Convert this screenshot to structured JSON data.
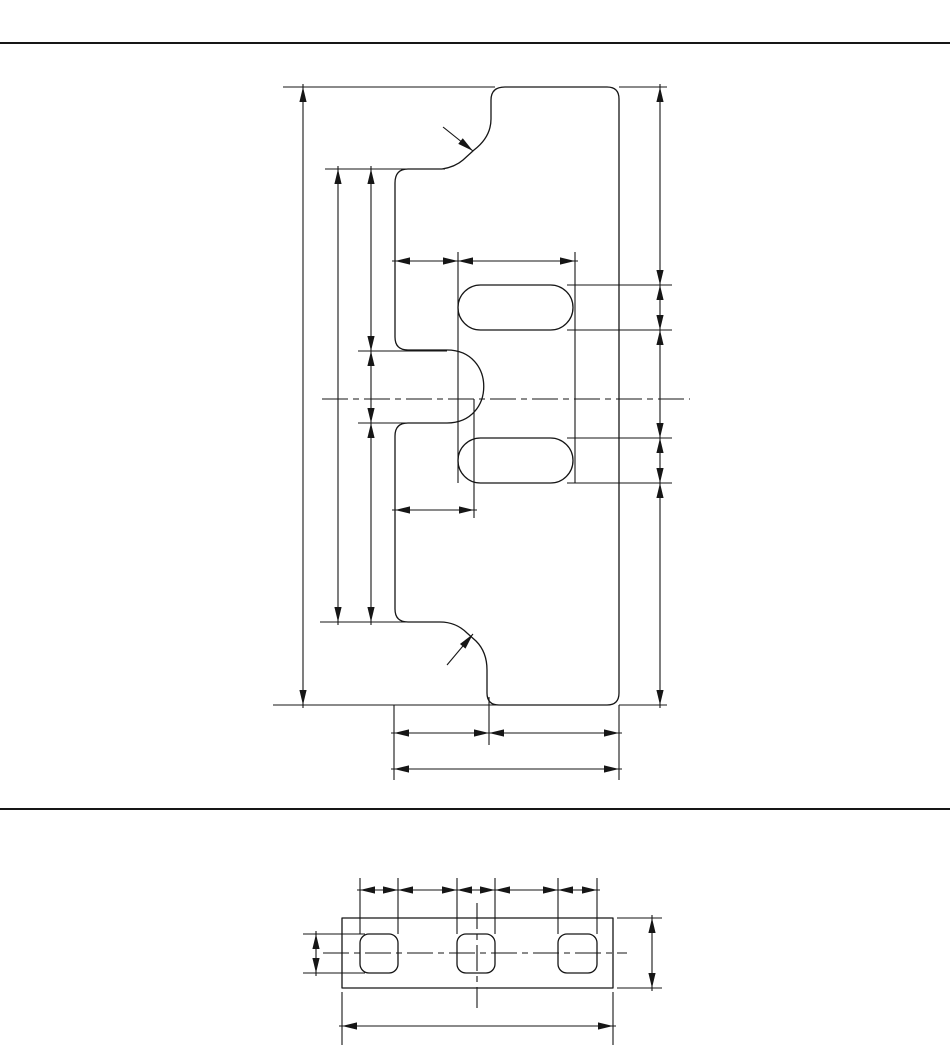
{
  "page": {
    "background": "#ffffff",
    "line_color": "#161616",
    "outline_stroke_width": 1.3,
    "thin_stroke_width": 1.1,
    "arrow_length": 15,
    "arrow_half_width": 3.6,
    "centerline_dash": "26 5 6 5"
  },
  "rules": [
    {
      "y": 43,
      "x1": 0,
      "x2": 950,
      "thickness": 2
    },
    {
      "y": 809,
      "x1": 0,
      "x2": 950,
      "thickness": 2
    }
  ],
  "views": [
    {
      "name": "profile-view",
      "outline": "M 505 87 L 607 87 Q 619 87 619 99 L 619 693 Q 619 705 607 705 L 499 705 Q 487 705 487 693 L 487 670 Q 487 652 476 641 L 467 633 Q 456 622 440 622 L 408 622 Q 395 622 395 609 L 395 436 Q 395 423 408 423 L 447 423 C 496 423 496 350 447 350 L 408 350 Q 395 350 395 337 L 395 183 Q 395 169 408 169 L 442 169 Q 455 167 463 160 L 474 150 Q 491 137 491 119 L 491 100 Q 491 87 505 87 Z",
      "slots": [
        {
          "x": 458,
          "y": 285,
          "w": 115,
          "h": 45,
          "r": 22.5
        },
        {
          "x": 458,
          "y": 438,
          "w": 115,
          "h": 45,
          "r": 22.5
        }
      ],
      "centerlines": [
        {
          "x1": 322,
          "y1": 399,
          "x2": 690,
          "y2": 399
        }
      ],
      "extensions": [
        [
          283,
          87,
          495,
          87
        ],
        [
          619,
          87,
          667,
          87
        ],
        [
          325,
          169,
          445,
          169
        ],
        [
          358,
          351,
          447,
          351
        ],
        [
          358,
          423,
          447,
          423
        ],
        [
          320,
          622,
          435,
          622
        ],
        [
          273,
          705,
          500,
          705
        ],
        [
          619,
          705,
          667,
          705
        ],
        [
          567,
          285,
          672,
          285
        ],
        [
          567,
          330,
          672,
          330
        ],
        [
          567,
          438,
          672,
          438
        ],
        [
          567,
          483,
          672,
          483
        ],
        [
          458,
          252,
          458,
          483
        ],
        [
          575,
          252,
          575,
          483
        ],
        [
          474,
          399,
          474,
          518
        ],
        [
          394,
          705,
          394,
          780
        ],
        [
          489,
          697,
          489,
          745
        ],
        [
          619,
          705,
          619,
          780
        ]
      ],
      "dims": [
        {
          "dir": "v",
          "pos": 303,
          "pts": [
            87,
            705
          ]
        },
        {
          "dir": "v",
          "pos": 338,
          "pts": [
            169,
            622
          ]
        },
        {
          "dir": "v",
          "pos": 371,
          "pts": [
            169,
            351,
            423,
            622
          ]
        },
        {
          "dir": "v",
          "pos": 660,
          "pts": [
            87,
            285,
            330,
            438,
            483,
            705
          ]
        },
        {
          "dir": "h",
          "pos": 261,
          "pts": [
            395,
            458,
            575
          ]
        },
        {
          "dir": "h",
          "pos": 510,
          "pts": [
            395,
            474
          ]
        },
        {
          "dir": "h",
          "pos": 733,
          "pts": [
            394,
            489,
            619
          ]
        },
        {
          "dir": "h",
          "pos": 769,
          "pts": [
            394,
            619
          ]
        }
      ],
      "leaders": [
        {
          "x1": 443,
          "y1": 127,
          "x2": 473,
          "y2": 151
        },
        {
          "x1": 447,
          "y1": 665,
          "x2": 473,
          "y2": 634
        }
      ]
    },
    {
      "name": "plan-view",
      "outline": "M 342 918 L 613 918 L 613 988 L 342 988 Z",
      "slots": [
        {
          "x": 360,
          "y": 934,
          "w": 38,
          "h": 39,
          "r": 9
        },
        {
          "x": 457,
          "y": 934,
          "w": 38,
          "h": 39,
          "r": 9
        },
        {
          "x": 558,
          "y": 934,
          "w": 39,
          "h": 39,
          "r": 9
        }
      ],
      "centerlines": [
        {
          "x1": 323,
          "y1": 953,
          "x2": 627,
          "y2": 953
        },
        {
          "x1": 477,
          "y1": 903,
          "x2": 477,
          "y2": 1008
        }
      ],
      "extensions": [
        [
          360,
          878,
          360,
          934
        ],
        [
          398,
          878,
          398,
          934
        ],
        [
          457,
          878,
          457,
          934
        ],
        [
          495,
          878,
          495,
          934
        ],
        [
          558,
          878,
          558,
          934
        ],
        [
          597,
          878,
          597,
          934
        ],
        [
          303,
          934,
          365,
          934
        ],
        [
          303,
          973,
          365,
          973
        ],
        [
          617,
          918,
          662,
          918
        ],
        [
          617,
          988,
          662,
          988
        ],
        [
          342,
          992,
          342,
          1045
        ],
        [
          613,
          992,
          613,
          1045
        ]
      ],
      "dims": [
        {
          "dir": "h",
          "pos": 890,
          "pts": [
            360,
            398,
            457,
            495,
            558,
            597
          ]
        },
        {
          "dir": "v",
          "pos": 316,
          "pts": [
            934,
            973
          ]
        },
        {
          "dir": "v",
          "pos": 652,
          "pts": [
            918,
            988
          ]
        },
        {
          "dir": "h",
          "pos": 1026,
          "pts": [
            342,
            613
          ]
        }
      ],
      "leaders": []
    }
  ]
}
